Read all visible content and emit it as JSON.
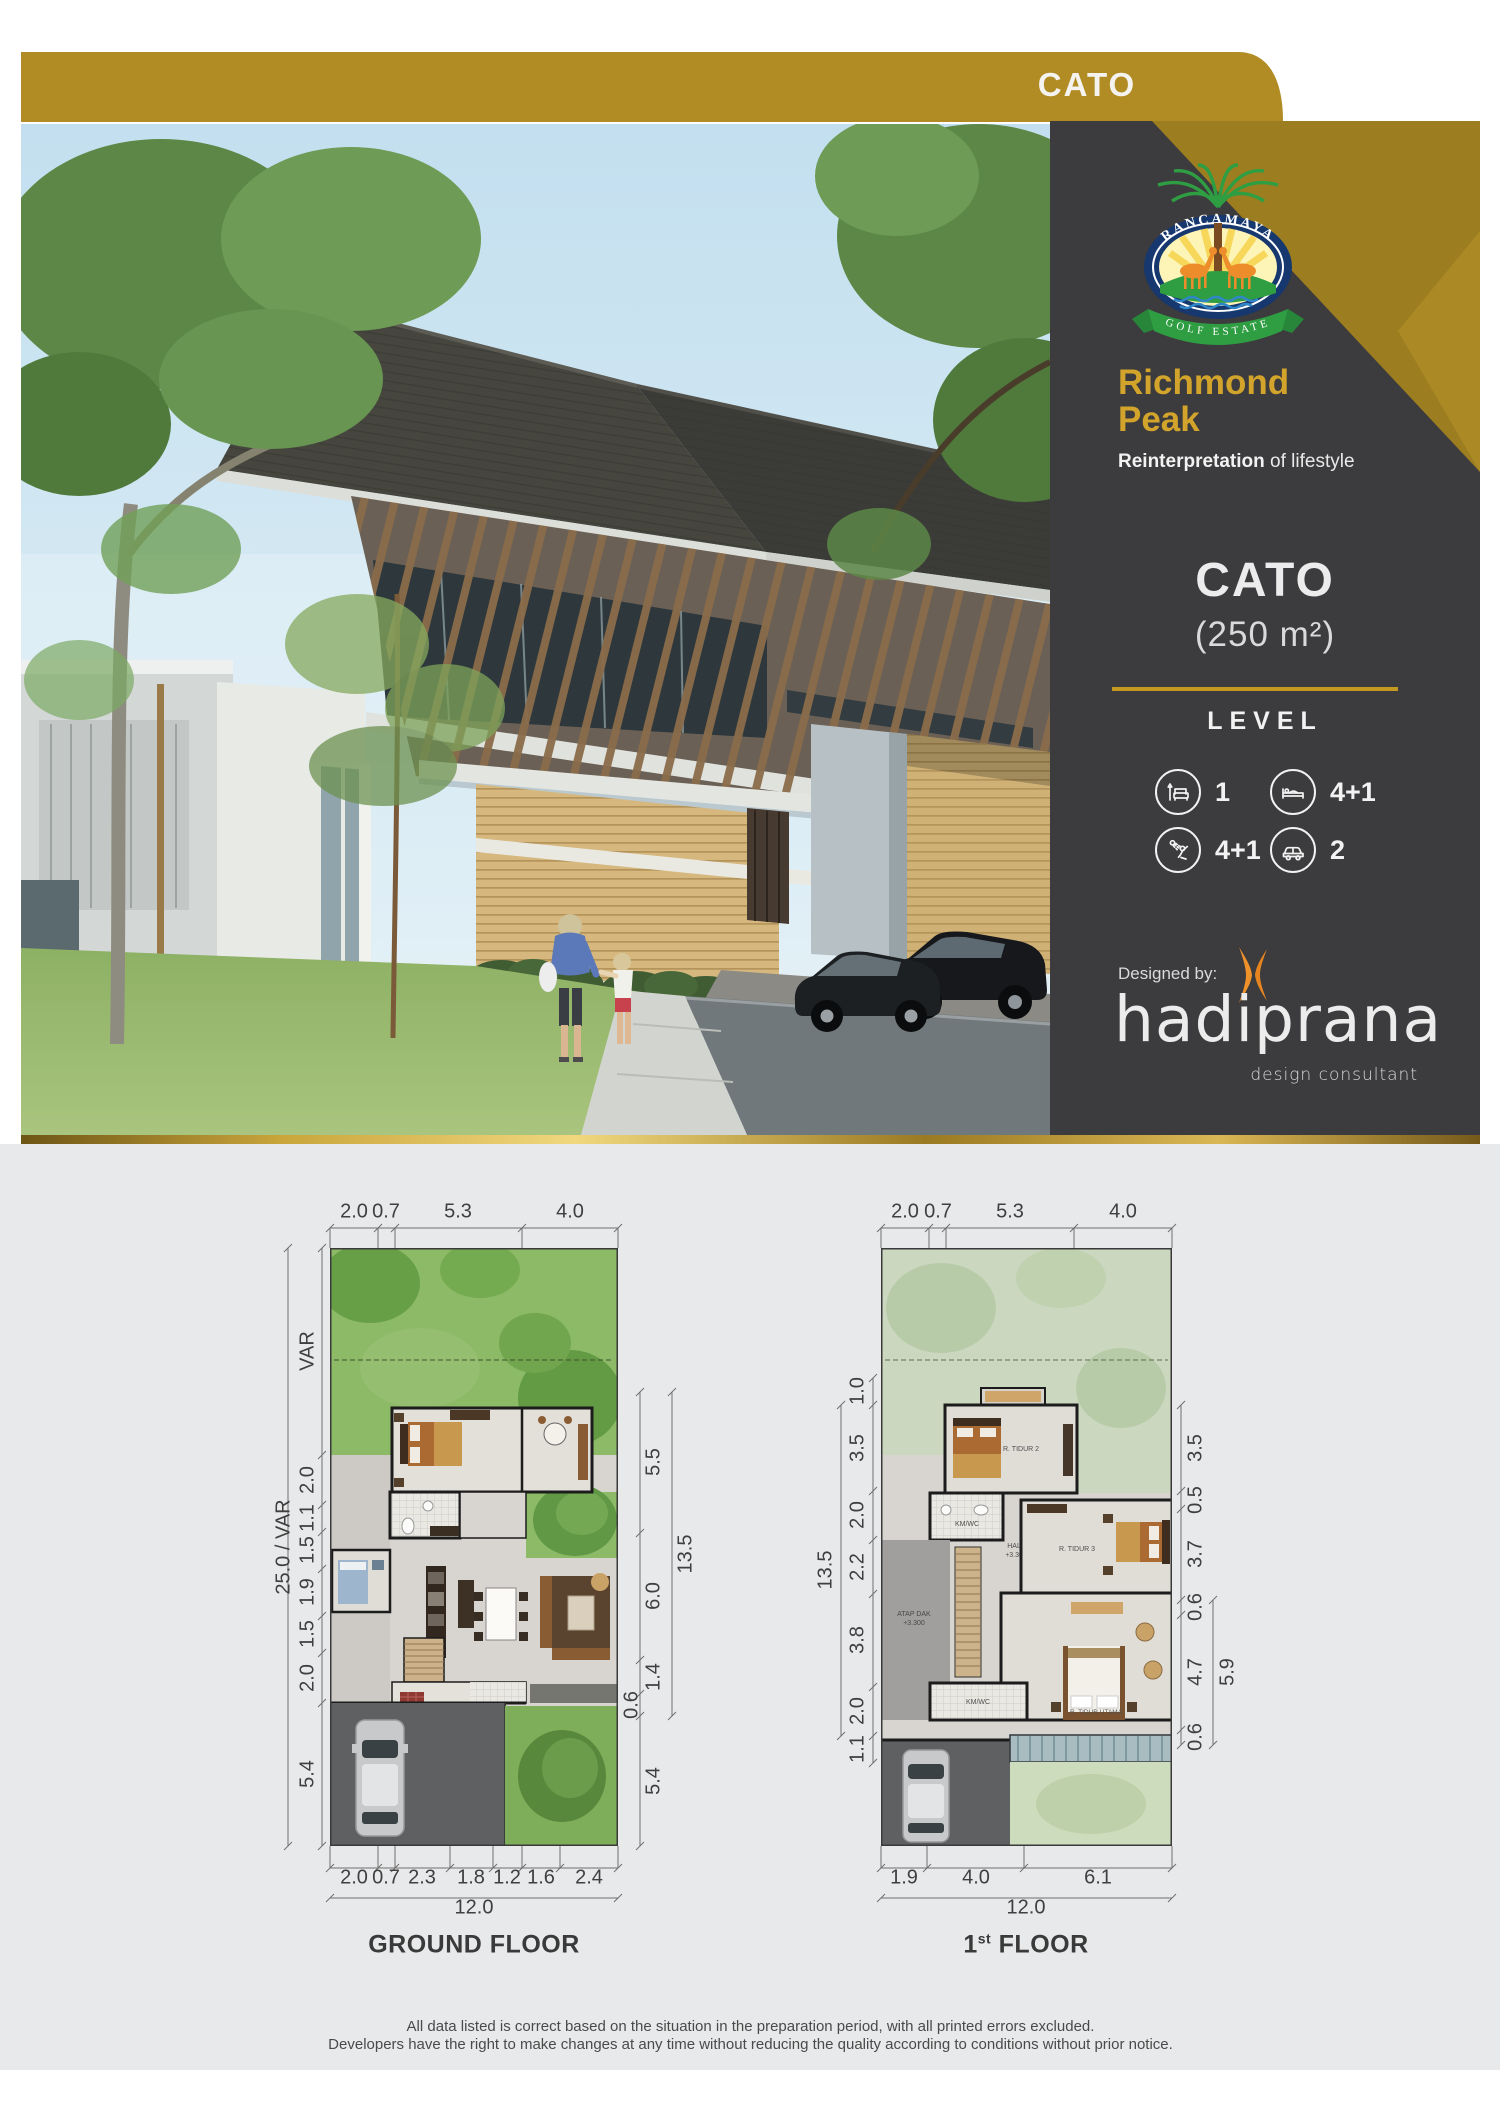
{
  "banner": {
    "label": "CATO"
  },
  "panel": {
    "logo": {
      "name": "RANCAMAYA",
      "subtitle": "GOLF ESTATE"
    },
    "brand": {
      "title_line1": "Richmond",
      "title_line2": "Peak",
      "tagline_bold": "Reinterpretation",
      "tagline_rest": " of lifestyle"
    },
    "unit": {
      "name": "CATO",
      "area": "(250 m²)"
    },
    "level": {
      "heading": "LEVEL",
      "items": [
        {
          "icon": "sofa-icon",
          "value": "1"
        },
        {
          "icon": "bed-icon",
          "value": "4+1"
        },
        {
          "icon": "shower-icon",
          "value": "4+1"
        },
        {
          "icon": "car-icon",
          "value": "2"
        }
      ]
    },
    "designed_by": {
      "label": "Designed by:",
      "firm": "hadiprana",
      "firm_subtitle": "design consultant"
    }
  },
  "plans": {
    "ground": {
      "title": "GROUND FLOOR",
      "top_dims": [
        "2.0",
        "0.7",
        "5.3",
        "4.0"
      ],
      "bottom_dims": [
        "2.0",
        "0.7",
        "2.3",
        "1.8",
        "1.2",
        "1.6",
        "2.4"
      ],
      "bottom_total": "12.0",
      "left_dims": [
        "VAR",
        "2.0",
        "1.1",
        "1.5",
        "1.9",
        "1.5",
        "2.0",
        "5.4"
      ],
      "left_total": "25.0 / VAR",
      "right_dims": [
        "5.5",
        "6.0",
        "1.4",
        "0.6",
        "5.4"
      ],
      "right_total": "13.5"
    },
    "first": {
      "title_num": "1",
      "title_sup": "st",
      "title_rest": " FLOOR",
      "top_dims": [
        "2.0",
        "0.7",
        "5.3",
        "4.0"
      ],
      "bottom_dims": [
        "1.9",
        "4.0",
        "6.1"
      ],
      "bottom_total": "12.0",
      "left_dims": [
        "1.0",
        "3.5",
        "2.0",
        "2.2",
        "3.8",
        "2.0",
        "1.1"
      ],
      "left_total": "13.5",
      "right_dims": [
        "3.5",
        "0.5",
        "3.7",
        "0.6",
        "4.7",
        "0.6"
      ],
      "right_total": "5.9",
      "annotations": {
        "bedroom2": "R. TIDUR 2",
        "bath_upper": "KM/WC",
        "hall": "HALL",
        "hall_level": "+3.300",
        "roof_deck": "ATAP DAK",
        "roof_deck_level": "+3.300",
        "bedroom3": "R. TIDUR 3",
        "master": "R. TIDUR UTAMA",
        "bath_lower": "KM/WC"
      }
    }
  },
  "footer": {
    "line1": "All data listed is correct based on the situation in the preparation period, with all printed errors excluded.",
    "line2": "Developers have the right to make changes at any time without reducing the quality according to conditions without prior notice."
  },
  "colors": {
    "gold": "#b18c24",
    "gold_dark": "#9c7d20",
    "panel_dark": "#3c3b3d",
    "accent_orange": "#f0922b"
  }
}
